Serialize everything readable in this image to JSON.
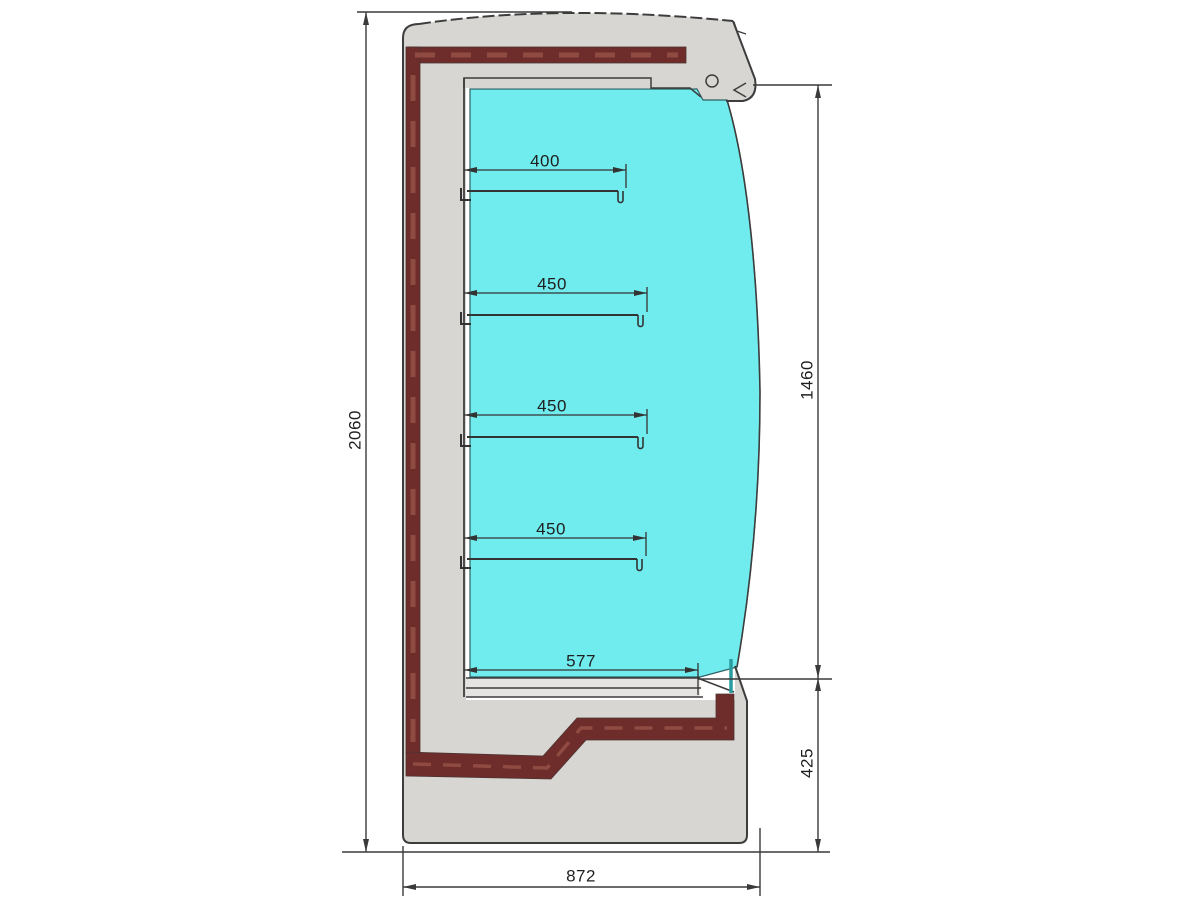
{
  "drawing": {
    "subject": "refrigerated multideck display cabinet cross-section",
    "dimension_labels": {
      "overall_height": "2060",
      "overall_depth": "872",
      "opening_height": "1460",
      "base_height": "425",
      "shelf_1_depth": "400",
      "shelf_2_depth": "450",
      "shelf_3_depth": "450",
      "shelf_4_depth": "450",
      "bottom_deck_depth": "577"
    },
    "colors": {
      "body": "#d8d6d3",
      "insulation": "#6e2d2a",
      "insulation_dash": "#8f4a42",
      "interior": "#70ecee",
      "deck_panel": "#e6e4e2",
      "outline": "#3d3d3d",
      "glass_seal": "#2a9c9e"
    }
  }
}
